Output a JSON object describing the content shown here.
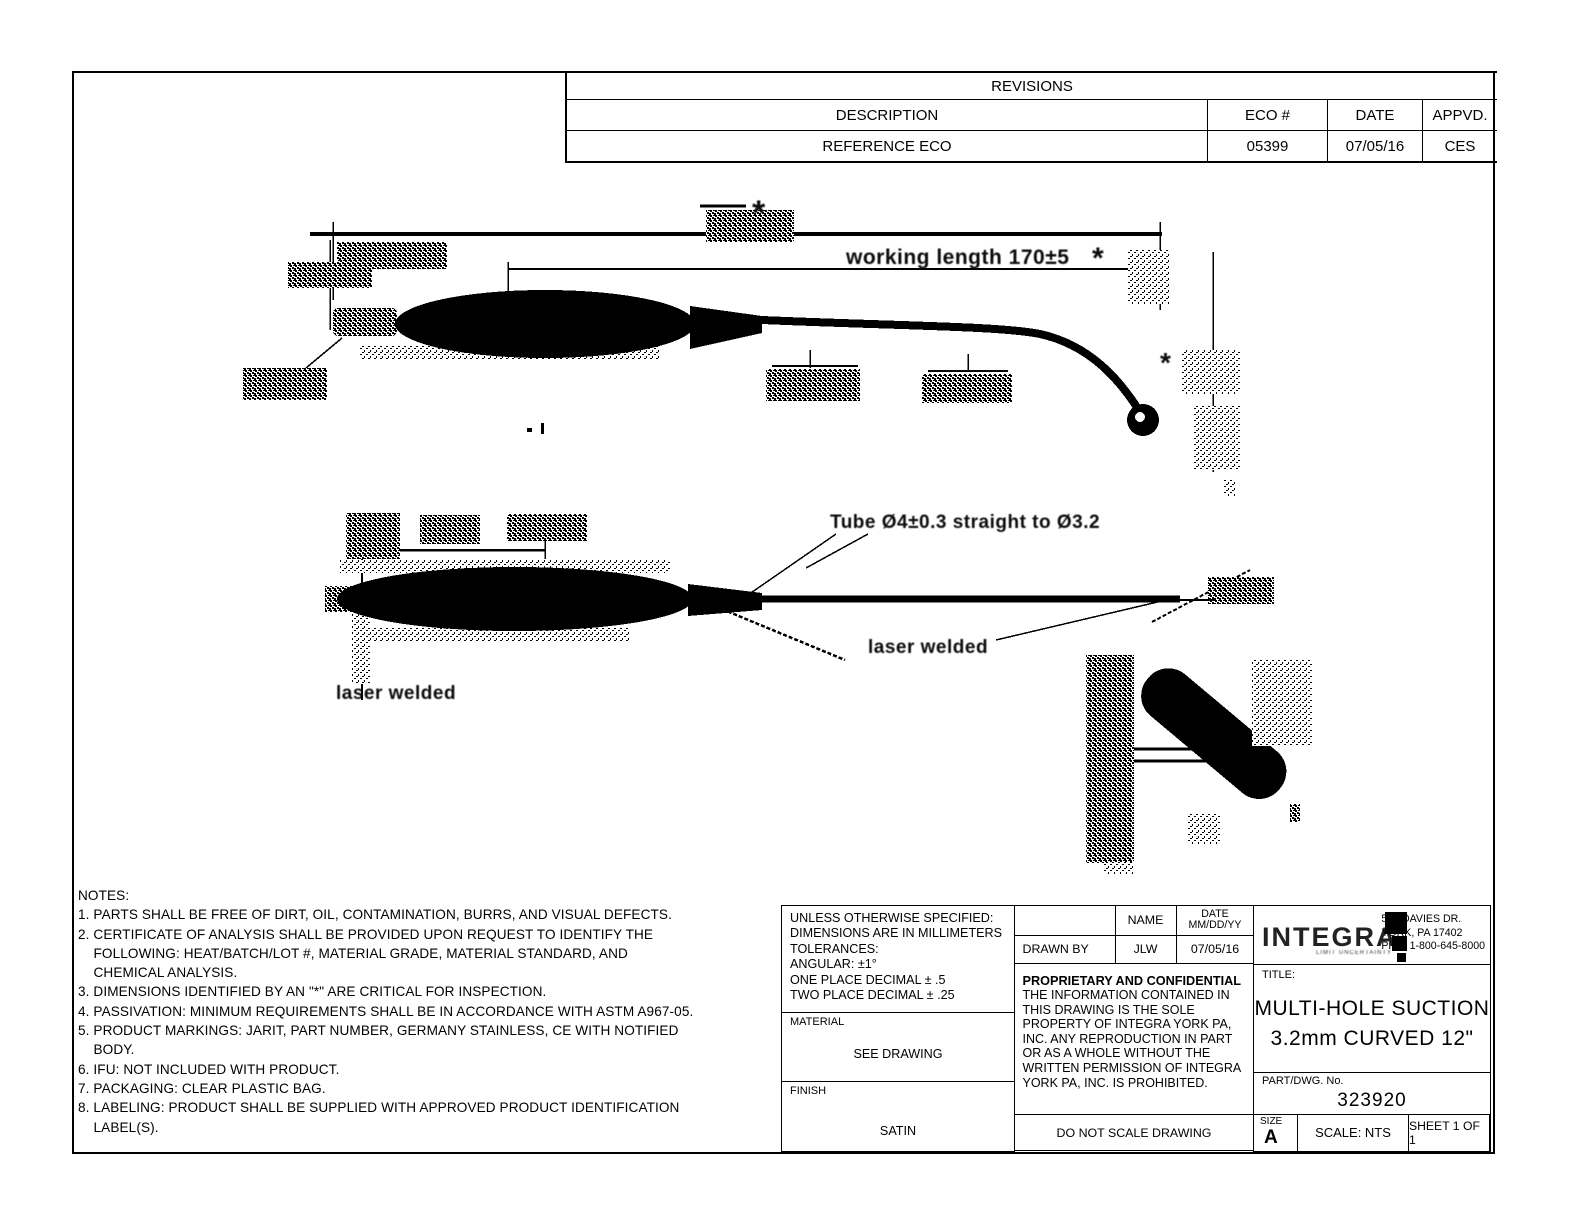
{
  "revisions": {
    "title": "REVISIONS",
    "columns": {
      "description": "DESCRIPTION",
      "eco": "ECO #",
      "date": "DATE",
      "appvd": "APPVD."
    },
    "row": {
      "description": "REFERENCE ECO",
      "eco": "05399",
      "date": "07/05/16",
      "appvd": "CES"
    }
  },
  "drawing": {
    "asterisk": "*",
    "working_length": "working length 170±5",
    "tube_spec": "Tube Ø4±0.3 straight to Ø3.2",
    "laser_welded_left": "laser welded",
    "laser_welded_right": "laser welded"
  },
  "notes": {
    "lines": [
      "NOTES:",
      "1. PARTS SHALL BE FREE OF DIRT, OIL, CONTAMINATION, BURRS, AND VISUAL DEFECTS.",
      "2. CERTIFICATE OF ANALYSIS SHALL BE PROVIDED UPON REQUEST TO IDENTIFY THE",
      "    FOLLOWING: HEAT/BATCH/LOT #, MATERIAL GRADE, MATERIAL STANDARD, AND",
      "    CHEMICAL ANALYSIS.",
      "3. DIMENSIONS IDENTIFIED BY AN \"*\" ARE CRITICAL FOR INSPECTION.",
      "4. PASSIVATION: MINIMUM REQUIREMENTS SHALL BE IN ACCORDANCE WITH ASTM A967-05.",
      "5. PRODUCT MARKINGS: JARIT, PART NUMBER, GERMANY STAINLESS, CE WITH NOTIFIED",
      "    BODY.",
      "6. IFU: NOT INCLUDED WITH PRODUCT.",
      "7. PACKAGING: CLEAR PLASTIC BAG.",
      "8. LABELING: PRODUCT SHALL BE SUPPLIED WITH APPROVED PRODUCT IDENTIFICATION",
      "    LABEL(S)."
    ]
  },
  "title_block": {
    "tolerances": [
      "UNLESS OTHERWISE SPECIFIED:",
      "DIMENSIONS ARE IN MILLIMETERS",
      "TOLERANCES:",
      "ANGULAR: ±1°",
      "ONE PLACE DECIMAL ± .5",
      "TWO PLACE DECIMAL ± .25"
    ],
    "material_label": "MATERIAL",
    "material_value": "SEE DRAWING",
    "finish_label": "FINISH",
    "finish_value": "SATIN",
    "name_header": "NAME",
    "date_header_line1": "DATE",
    "date_header_line2": "MM/DD/YY",
    "drawn_by_label": "DRAWN BY",
    "drawn_by_name": "JLW",
    "drawn_by_date": "07/05/16",
    "proprietary_title": "PROPRIETARY AND CONFIDENTIAL",
    "proprietary_body": "THE INFORMATION CONTAINED IN THIS DRAWING IS THE SOLE PROPERTY OF INTEGRA YORK PA, INC.  ANY REPRODUCTION IN PART OR AS A WHOLE WITHOUT THE WRITTEN PERMISSION OF INTEGRA YORK PA, INC. IS PROHIBITED.",
    "do_not_scale": "DO NOT SCALE DRAWING",
    "company": {
      "logo_text": "INTEGRA.",
      "tagline": "LIMIT UNCERTAINTY",
      "address": [
        "589 DAVIES DR.",
        "YORK, PA 17402",
        "PHN. 1-800-645-8000"
      ]
    },
    "title_label": "TITLE:",
    "title_line1": "MULTI-HOLE SUCTION",
    "title_line2": "3.2mm CURVED 12\"",
    "part_label": "PART/DWG. No.",
    "part_number": "323920",
    "size_label": "SIZE",
    "size_value": "A",
    "scale": "SCALE: NTS",
    "sheet": "SHEET 1 OF 1"
  }
}
